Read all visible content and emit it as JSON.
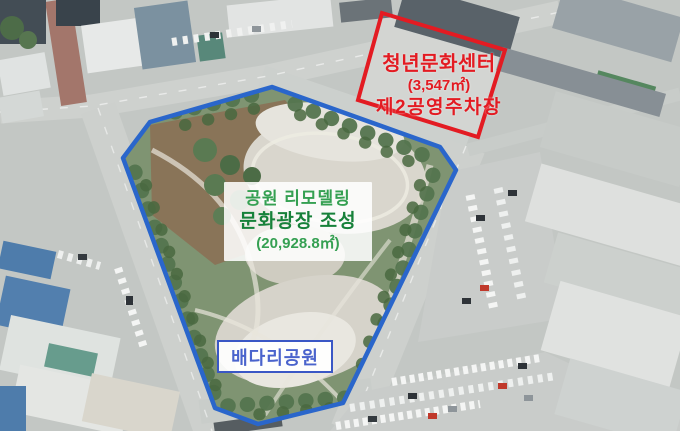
{
  "colors": {
    "outline_red": "#e31b22",
    "outline_blue": "#2a66cb",
    "text_red": "#e31b22",
    "green_text": "#35a052",
    "green_text_bold": "#17813a",
    "park_name_text": "#4a63cc",
    "park_name_border": "#3a57c5"
  },
  "annotations": {
    "youth_center": {
      "title": "청년문화센터",
      "area": "(3,547㎡)",
      "subtitle": "제2공영주차장"
    },
    "park_remodel": {
      "line1": "공원 리모델링",
      "line2": "문화광장 조성",
      "area": "(20,928.8㎡)"
    },
    "park_name": {
      "label": "배다리공원"
    }
  }
}
